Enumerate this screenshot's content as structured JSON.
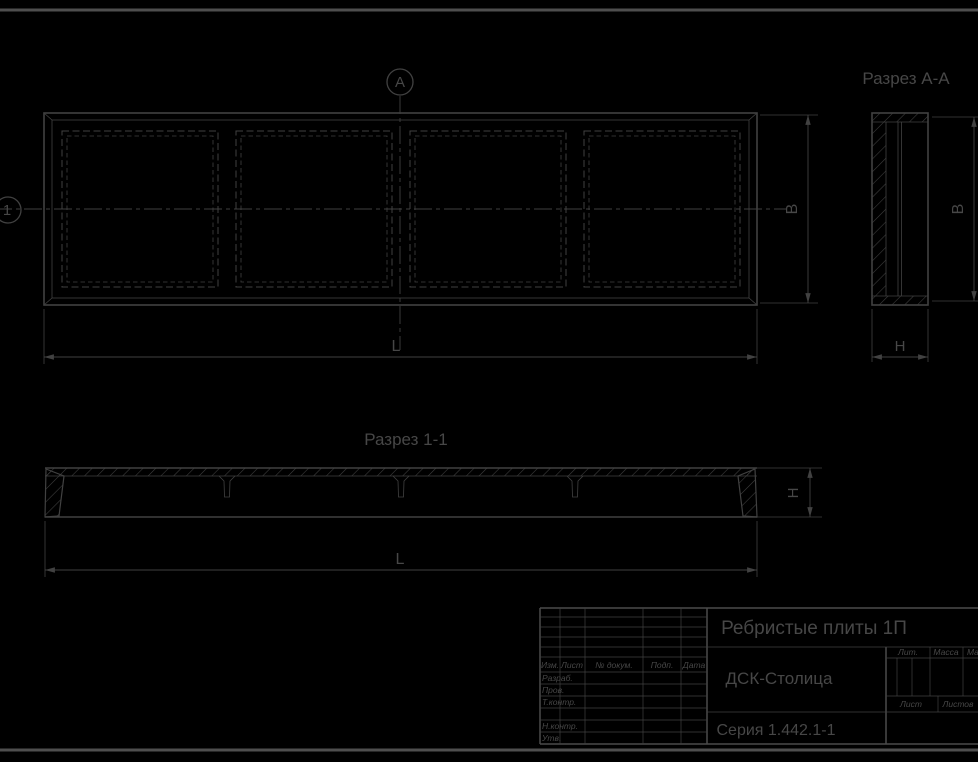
{
  "drawing": {
    "colors": {
      "background": "#000000",
      "line": "#414141",
      "text": "#474747"
    },
    "plan": {
      "axis_marker": "1",
      "section_marker": "А",
      "dim_length": "L",
      "dim_width": "В"
    },
    "section_aa": {
      "title": "Разрез А-А",
      "dim_width": "В",
      "dim_thickness": "Н"
    },
    "section_11": {
      "title": "Разрез 1-1",
      "dim_length": "L",
      "dim_height": "Н"
    },
    "title_block": {
      "product_name": "Ребристые плиты 1П",
      "organization": "ДСК-Столица",
      "document": "Серия 1.442.1-1",
      "columns": {
        "izm": "Изм.",
        "list": "Лист",
        "doc": "№ докум.",
        "podp": "Подп.",
        "data": "Дата"
      },
      "roles": {
        "developed": "Разраб.",
        "checked": "Пров.",
        "tcontrol": "Т.контр.",
        "ncontrol": "Н.контр.",
        "approved": "Утв."
      },
      "right": {
        "lit": "Лит.",
        "mass": "Масса",
        "scale": "Масштаб",
        "sheet": "Лист",
        "sheets": "Листов"
      }
    }
  }
}
